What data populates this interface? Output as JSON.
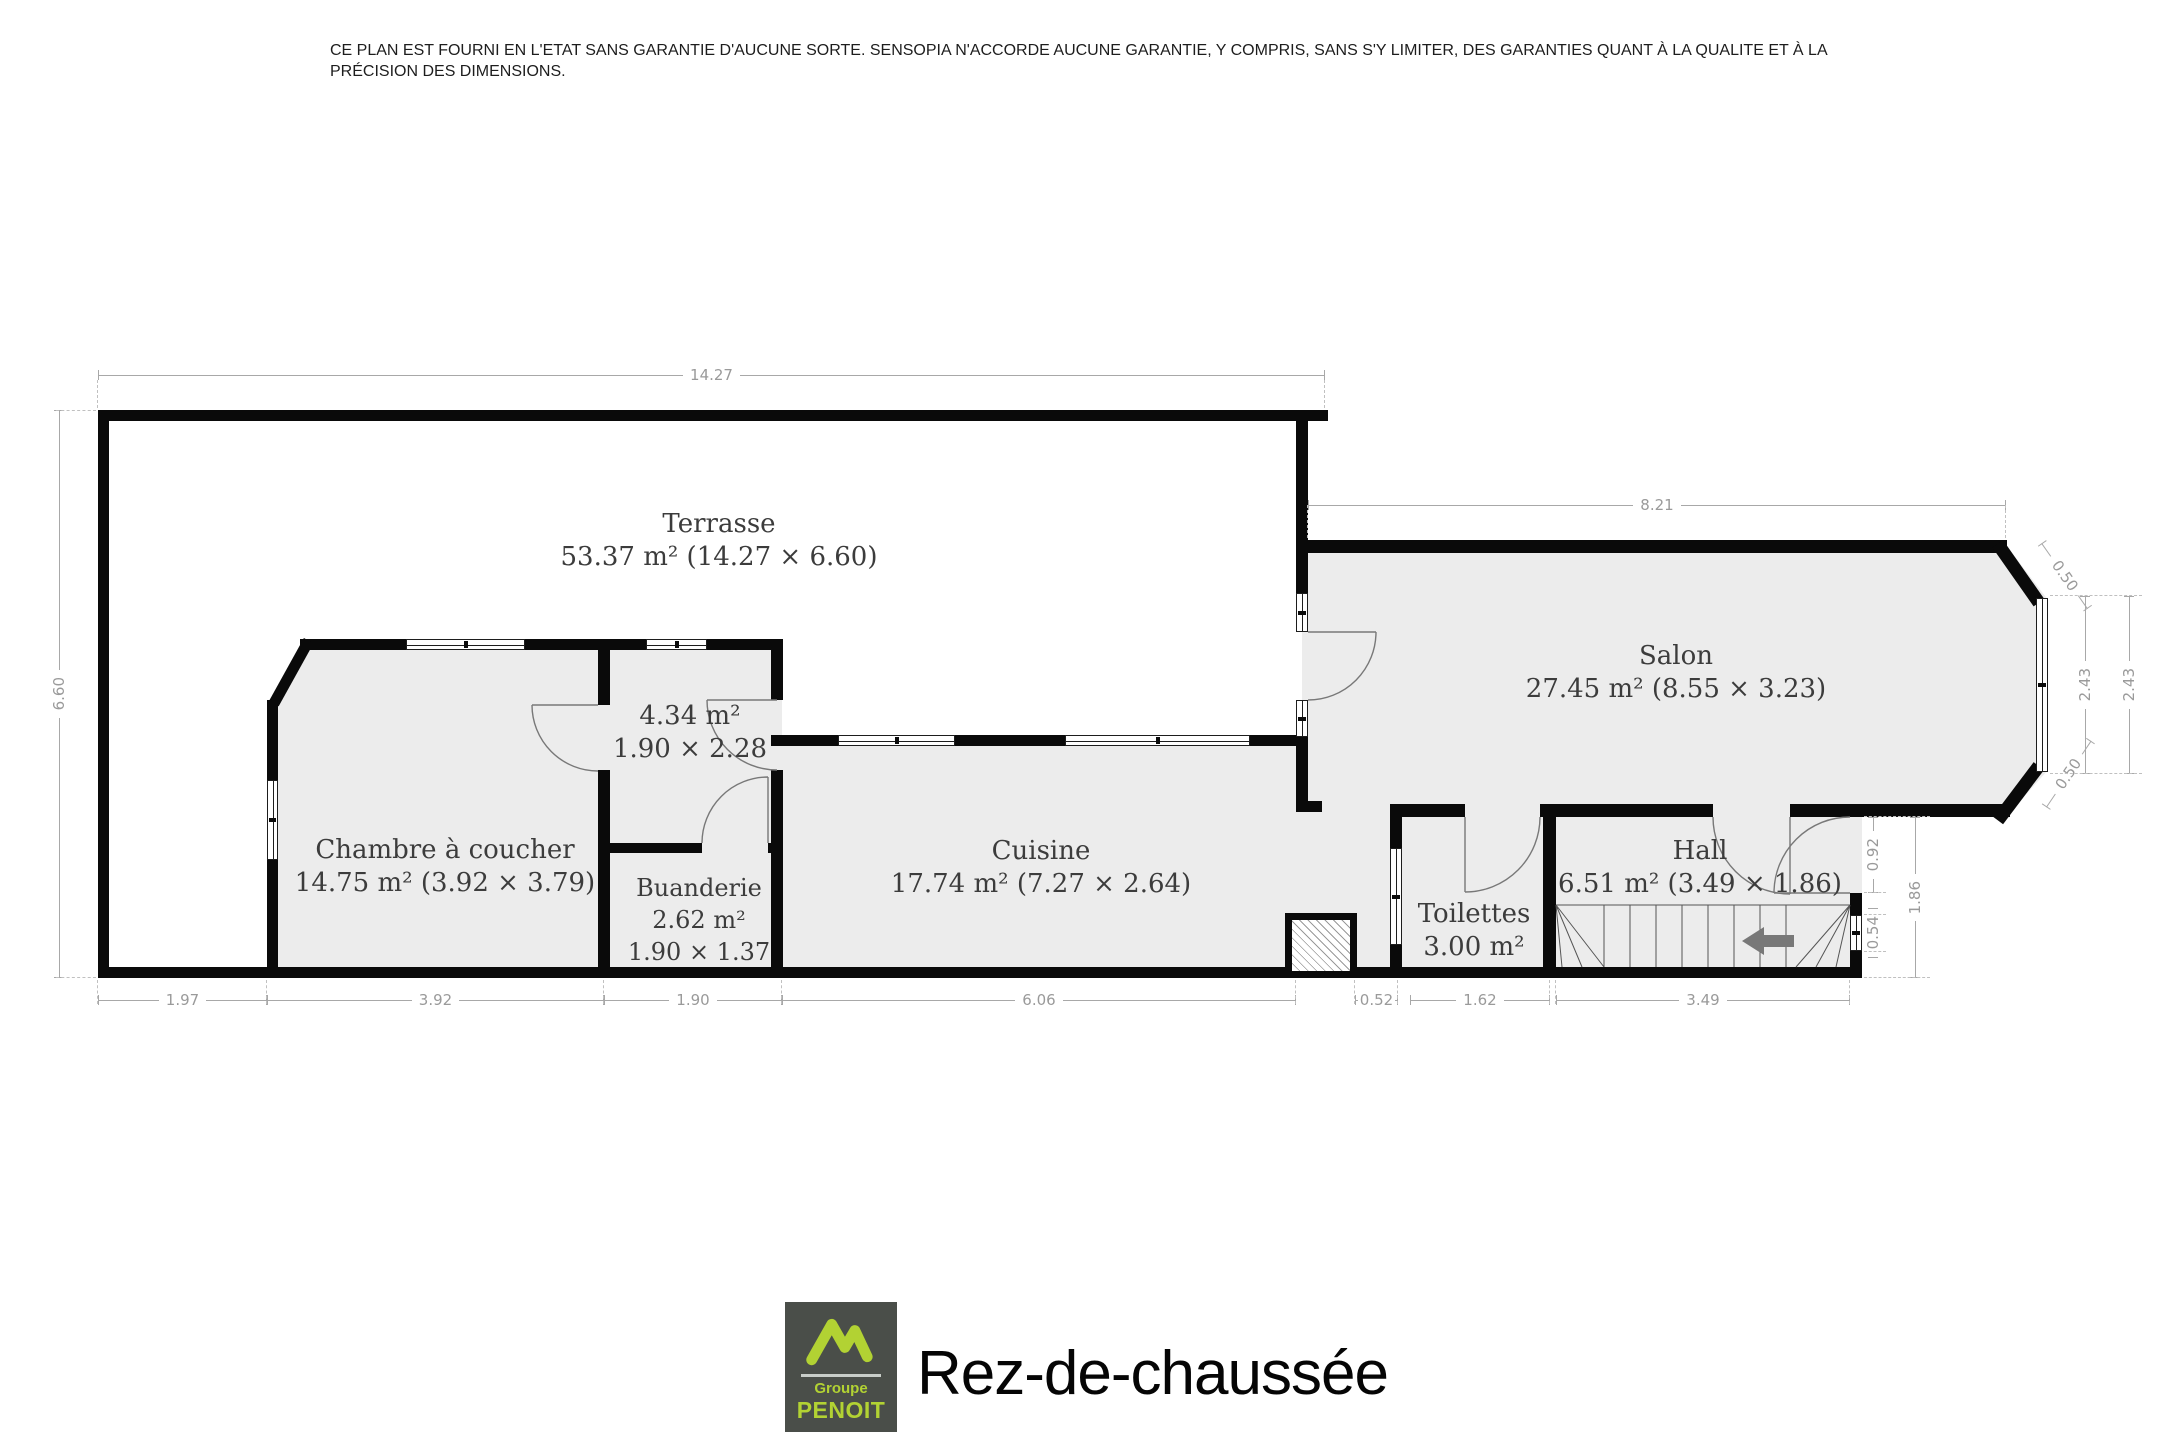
{
  "disclaimer": {
    "line1": "CE PLAN EST FOURNI EN L'ETAT SANS GARANTIE D'AUCUNE SORTE. SENSOPIA N'ACCORDE AUCUNE GARANTIE, Y COMPRIS, SANS S'Y LIMITER, DES GARANTIES QUANT À LA QUALITE ET À LA",
    "line2": "PRÉCISION DES DIMENSIONS."
  },
  "rooms": {
    "terrasse": {
      "line1": "Terrasse",
      "line2": "53.37 m² (14.27 × 6.60)"
    },
    "salon": {
      "line1": "Salon",
      "line2": "27.45 m² (8.55 × 3.23)"
    },
    "chambre": {
      "line1": "Chambre à coucher",
      "line2": "14.75 m² (3.92 × 3.79)"
    },
    "annexe": {
      "line1": "4.34 m²",
      "line2": "1.90 × 2.28"
    },
    "buanderie": {
      "line1": "Buanderie",
      "line2": "2.62 m²",
      "line3": "1.90 × 1.37"
    },
    "cuisine": {
      "line1": "Cuisine",
      "line2": "17.74 m² (7.27 × 2.64)"
    },
    "toilettes": {
      "line1": "Toilettes",
      "line2": "3.00 m²"
    },
    "hall": {
      "line1": "Hall",
      "line2": "6.51 m² (3.49 × 1.86)"
    }
  },
  "dims": {
    "top": "14.27",
    "left": "6.60",
    "salon_top": "8.21",
    "chamfer_top": "0.50",
    "chamfer_bottom": "0.50",
    "window_inner": "2.43",
    "window_outer": "2.43",
    "hall_door": "0.92",
    "hall_window": "0.54",
    "hall_depth": "1.86",
    "bottom": [
      "1.97",
      "3.92",
      "1.90",
      "6.06",
      "0.52",
      "1.62",
      "3.49"
    ]
  },
  "footer": {
    "title": "Rez-de-chaussée",
    "logo": {
      "line1": "Groupe",
      "line2": "PENOIT"
    }
  },
  "colors": {
    "wall": "#0a0a0a",
    "room_fill": "#ececec",
    "dimension": "#9a9a9a",
    "label": "#3c3c3c",
    "logo_background": "#4a4e49",
    "logo_green": "#b2d233"
  }
}
